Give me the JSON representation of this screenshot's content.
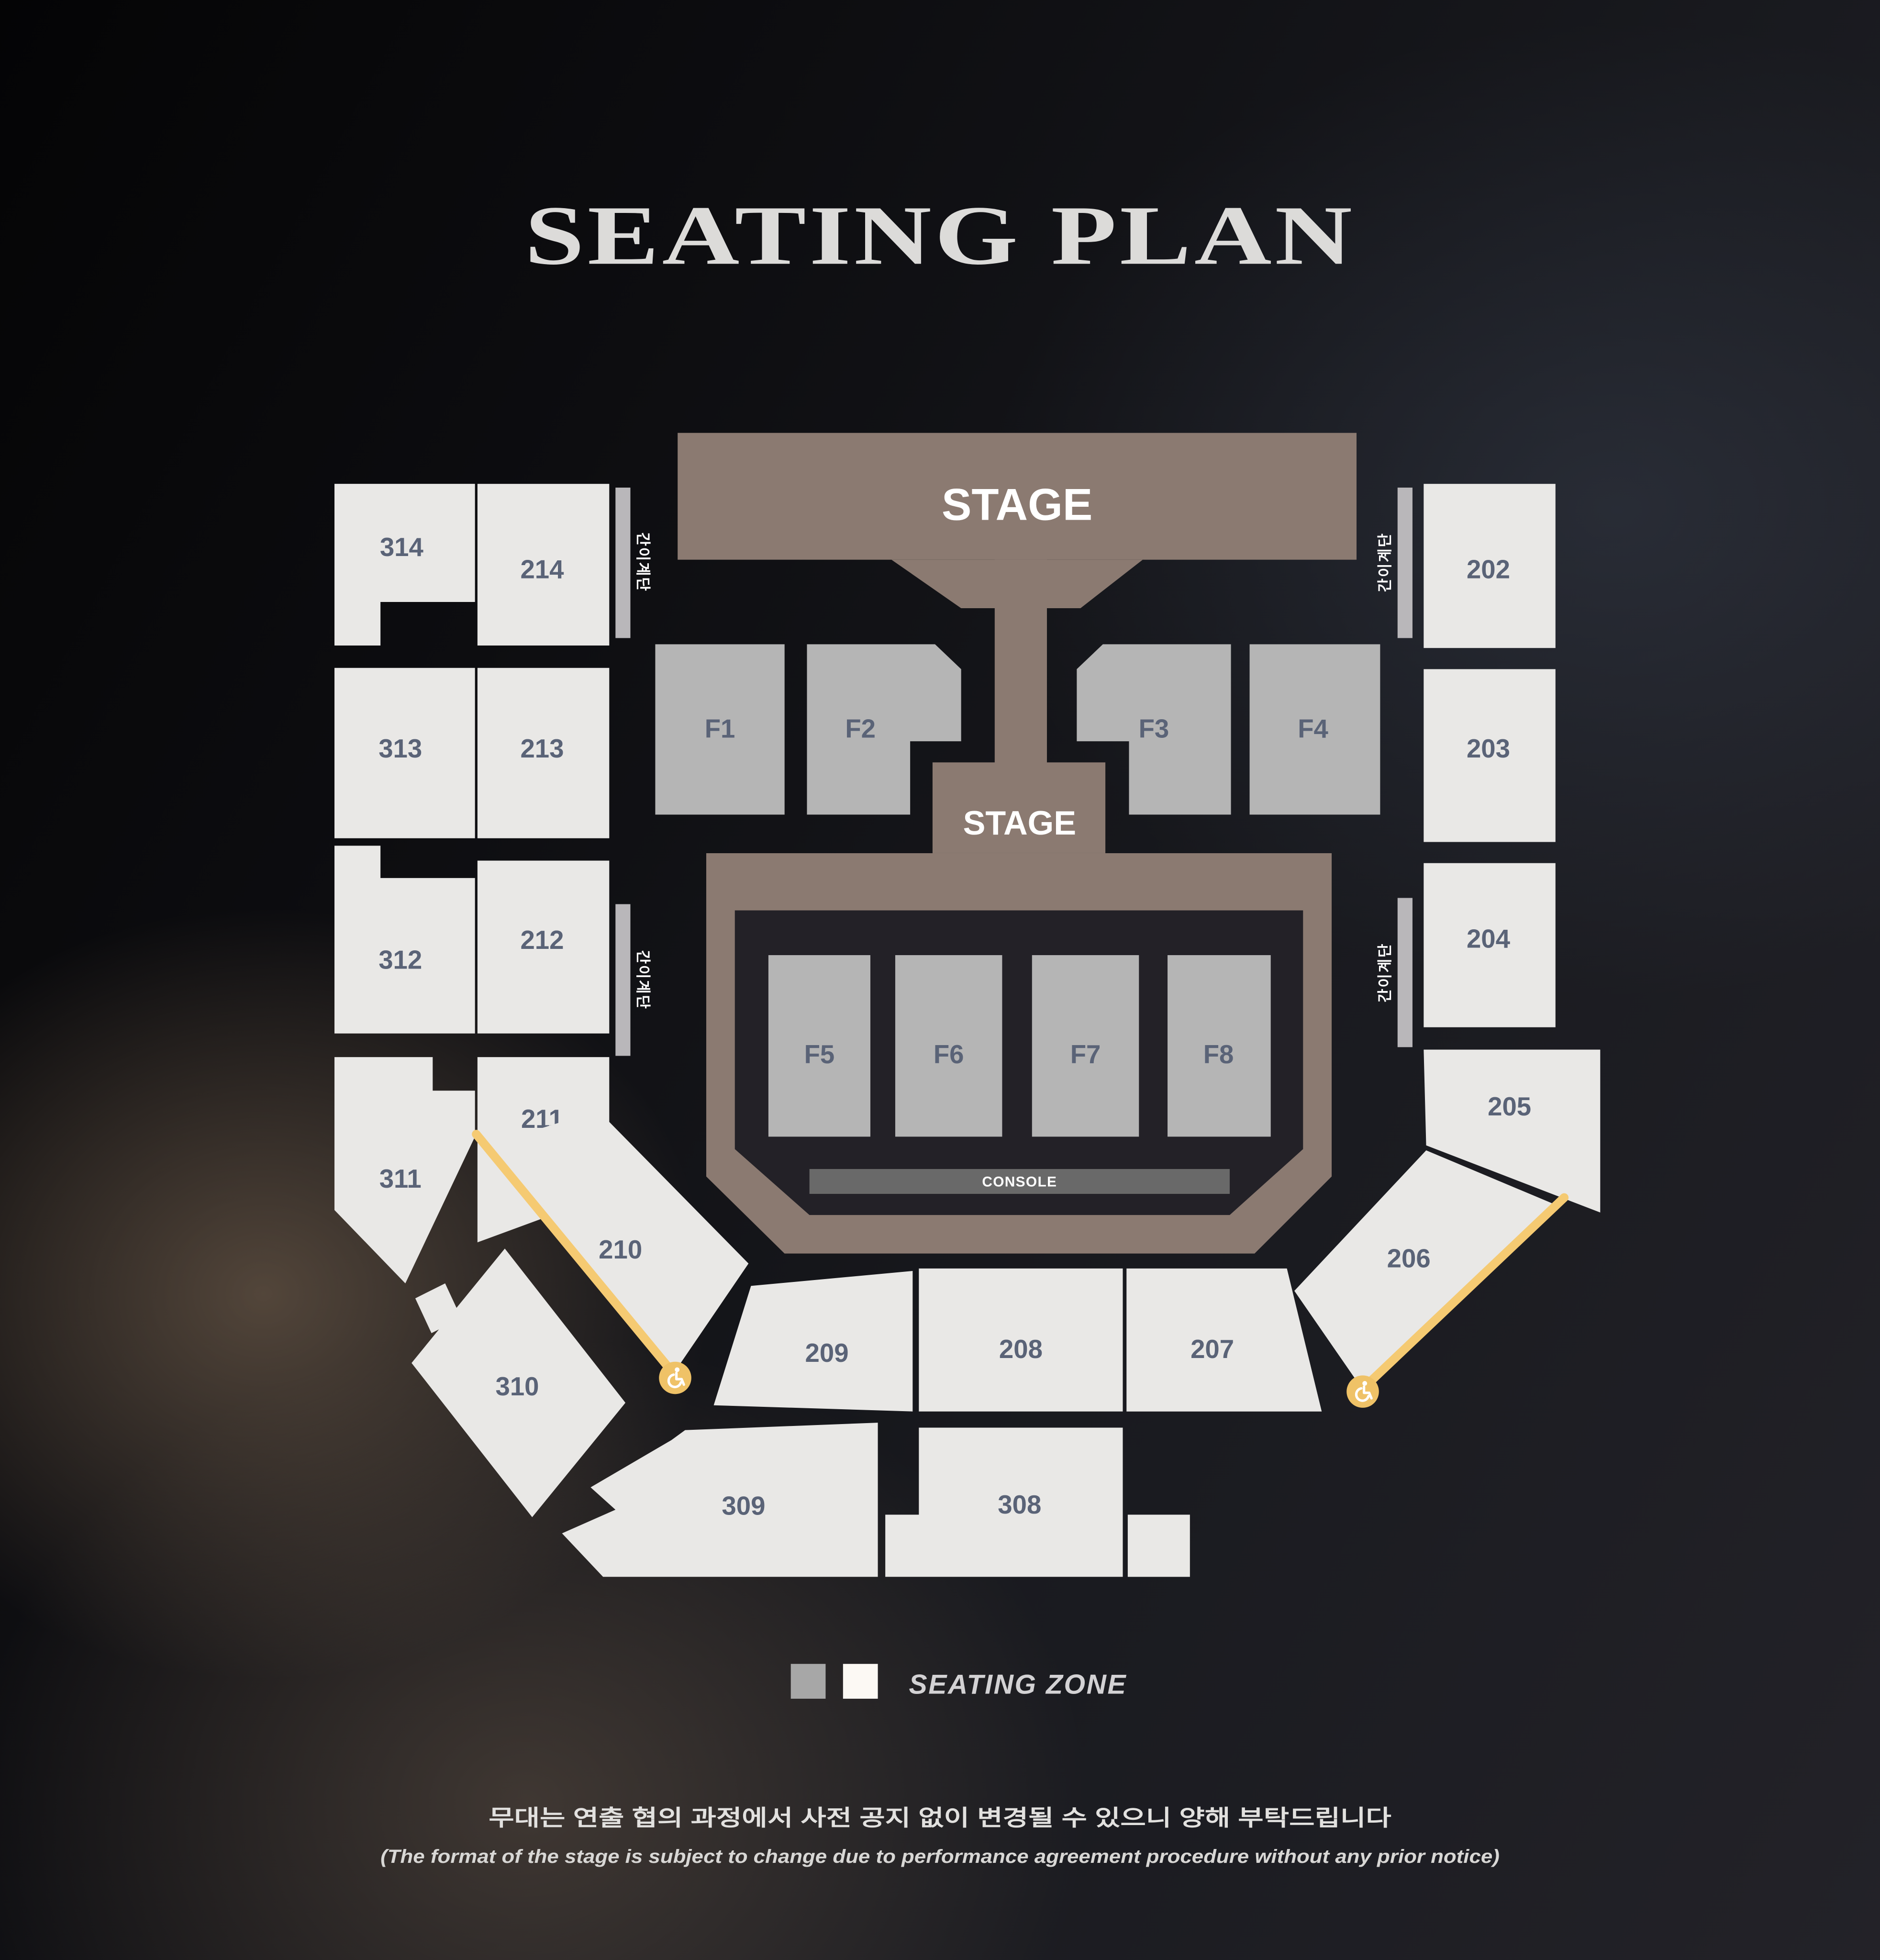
{
  "title": "SEATING PLAN",
  "stage": {
    "main_label": "STAGE",
    "thrust_label": "STAGE",
    "console_label": "CONSOLE"
  },
  "stairs": {
    "label": "간이계단"
  },
  "floor": {
    "F1": {
      "label": "F1"
    },
    "F2": {
      "label": "F2"
    },
    "F3": {
      "label": "F3"
    },
    "F4": {
      "label": "F4"
    },
    "F5": {
      "label": "F5"
    },
    "F6": {
      "label": "F6"
    },
    "F7": {
      "label": "F7"
    },
    "F8": {
      "label": "F8"
    }
  },
  "sections": {
    "202": {
      "label": "202"
    },
    "203": {
      "label": "203"
    },
    "204": {
      "label": "204"
    },
    "205": {
      "label": "205"
    },
    "206": {
      "label": "206"
    },
    "207": {
      "label": "207"
    },
    "208": {
      "label": "208"
    },
    "209": {
      "label": "209"
    },
    "210": {
      "label": "210"
    },
    "211": {
      "label": "211"
    },
    "212": {
      "label": "212"
    },
    "213": {
      "label": "213"
    },
    "214": {
      "label": "214"
    },
    "308": {
      "label": "308"
    },
    "309": {
      "label": "309"
    },
    "310": {
      "label": "310"
    },
    "311": {
      "label": "311"
    },
    "312": {
      "label": "312"
    },
    "313": {
      "label": "313"
    },
    "314": {
      "label": "314"
    }
  },
  "legend": {
    "label": "SEATING ZONE",
    "floor_swatch_color": "#a7a7a7",
    "seat_swatch_color": "#fcf9f4"
  },
  "footer": {
    "korean": "무대는 연출 협의 과정에서 사전 공지 없이 변경될 수 있으니 양해 부탁드립니다",
    "english": "(The format of the stage is subject to change due to performance agreement procedure without any prior notice)"
  },
  "colors": {
    "stage": "#8b7a71",
    "seating_zone": "#e9e8e6",
    "floor_zone": "#b5b5b5",
    "ramp_accent": "#f5ca72",
    "section_label": "#5a6377"
  }
}
